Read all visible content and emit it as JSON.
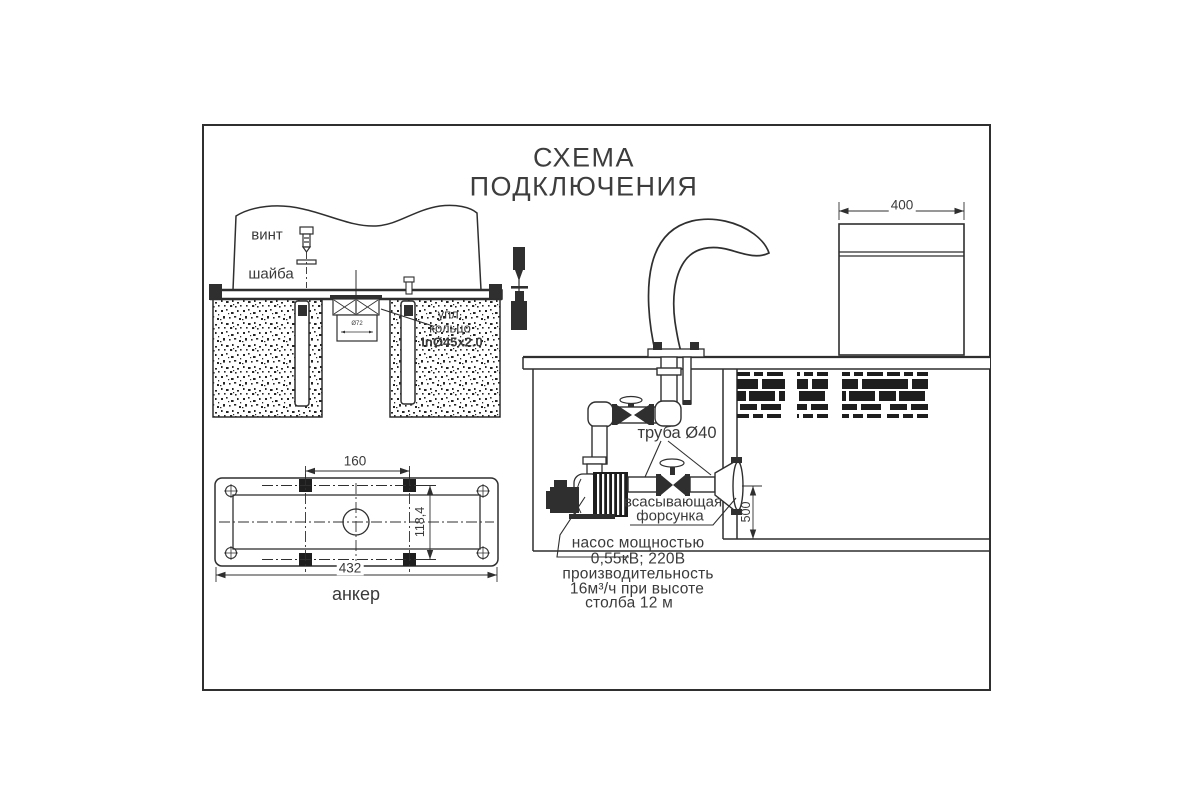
{
  "title": {
    "line1": "СХЕМА",
    "line2": "ПОДКЛЮЧЕНИЯ"
  },
  "mount_detail": {
    "screw_label": "винт",
    "washer_label": "шайба",
    "seal_ring_label_line1": "упл.",
    "seal_ring_label_line2": "кольцо",
    "seal_ring_spec": "InØ45x2.0",
    "center_hole_dim": "Ø72"
  },
  "anchor_plate": {
    "label": "анкер",
    "dim_bolt_spacing": "160",
    "dim_plate_length": "432",
    "dim_plate_width": "118,4"
  },
  "fountain": {
    "dim_cascade_width": "400",
    "dim_nozzle_depth": "500",
    "pipe_label": "труба Ø40",
    "suction_nozzle_label_line1": "всасывающая",
    "suction_nozzle_label_line2": "форсунка",
    "pump_note_line1": "насос мощностью",
    "pump_note_line2": "0,55кВ; 220В",
    "pump_note_line3": "производительность",
    "pump_note_line4": "16м³/ч при высоте",
    "pump_note_line5": "столба 12 м"
  },
  "colors": {
    "line": "#2f2f2f",
    "text": "#3a3a3a",
    "background": "#ffffff"
  }
}
